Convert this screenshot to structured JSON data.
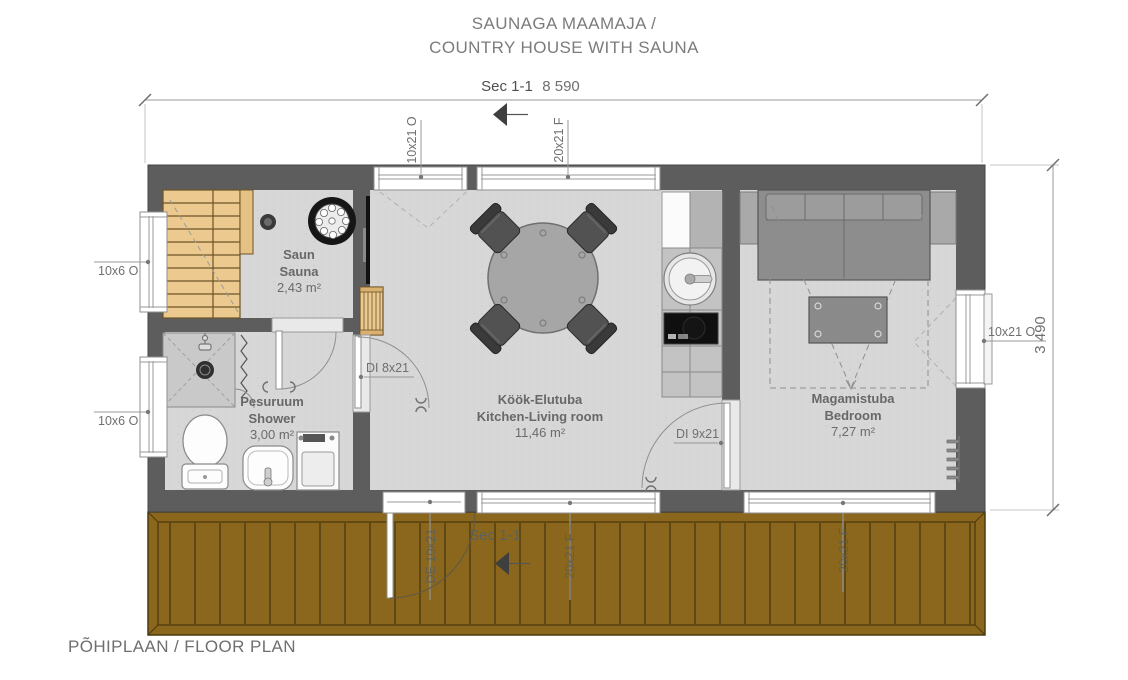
{
  "title": {
    "line1": "SAUNAGA MAAMAJA /",
    "line2": "COUNTRY HOUSE WITH SAUNA"
  },
  "footer": "PÕHIPLAAN / FLOOR PLAN",
  "section_markers": {
    "top": "Sec 1-1",
    "bottom": "Sec 1-1"
  },
  "dimensions": {
    "overall_width": "8 590",
    "overall_depth": "3 490"
  },
  "rooms": [
    {
      "name_et": "Saun",
      "name_en": "Sauna",
      "area": "2,43 m²"
    },
    {
      "name_et": "Pesuruum",
      "name_en": "Shower",
      "area": "3,00 m²"
    },
    {
      "name_et": "Köök-Elutuba",
      "name_en": "Kitchen-Living room",
      "area": "11,46 m²"
    },
    {
      "name_et": "Magamistuba",
      "name_en": "Bedroom",
      "area": "7,27 m²"
    }
  ],
  "openings": {
    "left_sauna_window": "10x6 O",
    "left_shower_window": "10x6 O",
    "top_living_window_left": "10x21 O",
    "top_living_window_right": "20x21 F",
    "right_bedroom_window": "10x21 O",
    "door_shower_living": "DI 8x21",
    "door_living_bedroom": "DI 9x21",
    "exterior_door": "DE 10x21",
    "bottom_living_window": "20x21 F",
    "bottom_bedroom_window": "20x21 F"
  },
  "colors": {
    "wall": "#5d5d5d",
    "floor": "#d7d7d7",
    "deck": "#8a671c",
    "bench_wood": "#ecca8f",
    "annotation_text": "#6f6f6f"
  }
}
